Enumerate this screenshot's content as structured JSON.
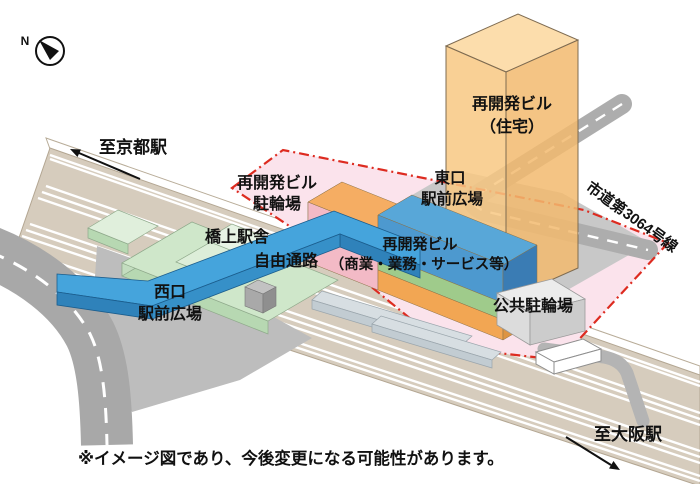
{
  "labels": {
    "compass_n": "N",
    "to_kyoto": "至京都駅",
    "to_osaka": "至大阪駅",
    "redevelopment_bicycle_line1": "再開発ビル",
    "redevelopment_bicycle_line2": "駐輪場",
    "bridge_station": "橋上駅舎",
    "free_passage": "自由通路",
    "west_exit_line1": "西口",
    "west_exit_line2": "駅前広場",
    "east_exit_line1": "東口",
    "east_exit_line2": "駅前広場",
    "tower_line1": "再開発ビル",
    "tower_line2": "（住宅）",
    "commercial_line1": "再開発ビル",
    "commercial_line2": "（商業・業務・サービス等）",
    "public_bicycle": "公共駐輪場",
    "city_road": "市道第3064号線",
    "note": "※イメージ図であり、今後変更になる可能性があります。"
  },
  "colors": {
    "zone_pink": "#fbe3ec",
    "boundary_red": "#dd2b20",
    "track_tan": "#d6ccbd",
    "road_gray": "#a8a8a8",
    "city_road_gray": "#adadad",
    "west_plaza_gray": "#bdbdbd",
    "east_plaza_gray": "#c8c8c8",
    "tower_orange": "#f8c883",
    "building_orange": "#f5ad63",
    "building_pink": "#f3bac6",
    "building_blue": "#58a7d8",
    "building_green": "#9fcb8b",
    "walkway_blue": "#45a4dc",
    "station_green": "#cfe7ca",
    "parking_gray": "#ececec"
  }
}
